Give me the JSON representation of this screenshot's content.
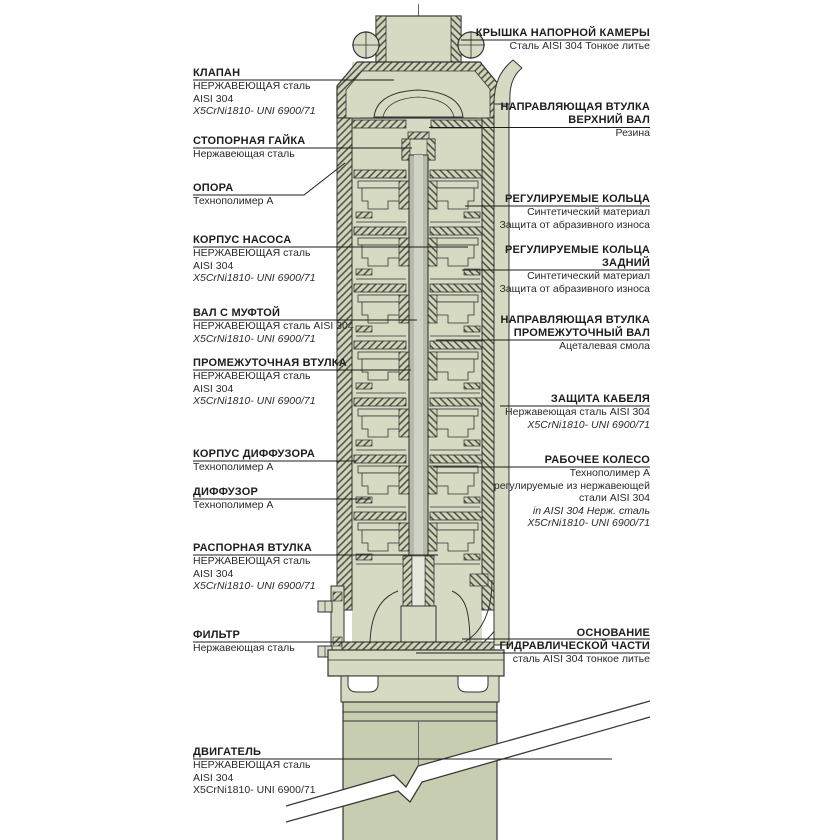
{
  "drawing": {
    "subject": "submersible borehole pump cross-section",
    "body_color": "#d6dac3",
    "hatch_color": "#45453c",
    "motor_color": "#c7cdb1",
    "shaft_color": "#b5baab",
    "line_color": "#333333",
    "leader_color": "#1c1c1a"
  },
  "labels": {
    "left": [
      {
        "title": "КЛАПАН",
        "lines": [
          "НЕРЖАВЕЮЩАЯ сталь",
          "AISI 304",
          "X5CrNi1810- UNI 6900/71"
        ]
      },
      {
        "title": "СТОПОРНАЯ ГАЙКА",
        "lines": [
          "Нержавеющая сталь"
        ]
      },
      {
        "title": "ОПОРА",
        "lines": [
          "Технополимер А"
        ]
      },
      {
        "title": "КОРПУС НАСОСА",
        "lines": [
          "НЕРЖАВЕЮЩАЯ сталь",
          "AISI 304",
          "X5CrNi1810- UNI 6900/71"
        ]
      },
      {
        "title": "ВАЛ С МУФТОЙ",
        "lines": [
          "НЕРЖАВЕЮЩАЯ сталь  AISI 304",
          "X5CrNi1810- UNI 6900/71"
        ]
      },
      {
        "title": "ПРОМЕЖУТОЧНАЯ ВТУЛКА",
        "lines": [
          "НЕРЖАВЕЮЩАЯ сталь",
          "AISI 304",
          "X5CrNi1810- UNI 6900/71"
        ]
      },
      {
        "title": "КОРПУС ДИФФУЗОРА",
        "lines": [
          "Технополимер А"
        ]
      },
      {
        "title": "ДИФФУЗОР",
        "lines": [
          "Технополимер А"
        ]
      },
      {
        "title": "РАСПОРНАЯ ВТУЛКА",
        "lines": [
          "НЕРЖАВЕЮЩАЯ сталь",
          "AISI 304",
          "X5CrNi1810- UNI 6900/71"
        ]
      },
      {
        "title": "ФИЛЬТР",
        "lines": [
          "Нержавеющая сталь"
        ]
      },
      {
        "title": "ДВИГАТЕЛЬ",
        "lines": [
          "НЕРЖАВЕЮЩАЯ сталь",
          "AISI 304",
          "X5CrNi1810- UNI 6900/71"
        ]
      }
    ],
    "right": [
      {
        "title": "КРЫШКА НАПОРНОЙ КАМЕРЫ",
        "lines": [
          "Сталь AISI 304 Тонкое литье"
        ]
      },
      {
        "pretitle": "НАПРАВЛЯЮЩАЯ ВТУЛКА",
        "title": "ВЕРХНИЙ ВАЛ",
        "lines": [
          "Резина"
        ]
      },
      {
        "title": "РЕГУЛИРУЕМЫЕ КОЛЬЦА",
        "lines": [
          "Синтетический материал",
          "Защита от абразивного износа"
        ]
      },
      {
        "pretitle": "РЕГУЛИРУЕМЫЕ КОЛЬЦА",
        "title": "ЗАДНИЙ",
        "lines": [
          "Синтетический материал",
          "Защита от абразивного износа"
        ]
      },
      {
        "pretitle": "НАПРАВЛЯЮЩАЯ ВТУЛКА",
        "title": "ПРОМЕЖУТОЧНЫЙ ВАЛ",
        "lines": [
          "Ацеталевая смола"
        ]
      },
      {
        "title": "ЗАЩИТА КАБЕЛЯ",
        "lines": [
          "Нержавеющая сталь AISI 304",
          "X5CrNi1810- UNI 6900/71"
        ]
      },
      {
        "title": "РАБОЧЕЕ КОЛЕСО",
        "lines": [
          "Технополимер А",
          "регулируемые из нержавеющей",
          "стали AISI 304",
          "in AISI 304 Нерж. сталь",
          "X5CrNi1810- UNI 6900/71"
        ]
      },
      {
        "pretitle": "ОСНОВАНИЕ",
        "title": "ГИДРАВЛИЧЕСКОЙ ЧАСТИ",
        "lines": [
          "сталь AISI 304 тонкое литье"
        ]
      }
    ]
  }
}
